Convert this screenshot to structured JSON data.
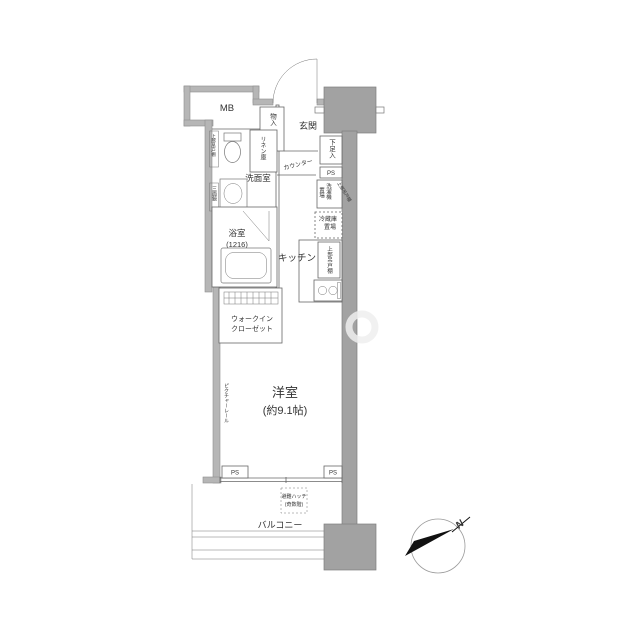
{
  "fp": {
    "mb": "MB",
    "entrance": "玄関",
    "storage": "物入",
    "shoe": "下足入",
    "ps": "PS",
    "washer_c1": "洗濯機",
    "washer_c2": "置場",
    "cab_tilt": "上部吊戸棚",
    "fridge1": "冷蔵庫",
    "fridge2": "置場",
    "cab_kitchen": "上部吊戸棚",
    "cab_washroom": "上部吊戸棚",
    "linen": "リネン庫",
    "washroom": "洗面室",
    "mirror": "三面鏡",
    "bath": "浴室",
    "bath_size": "(1216)",
    "counter": "カウンター",
    "kitchen": "キッチン",
    "wic1": "ウォークイン",
    "wic2": "クローゼット",
    "rail": "ピクチャーレール",
    "room": "洋室",
    "room_size": "(約9.1帖)",
    "hatch1": "避難ハッチ",
    "hatch2": "(奇数階)",
    "balcony": "バルコニー",
    "north": "N",
    "colors": {
      "wall": "#b6b6b6",
      "pillar": "#a2a2a2",
      "line": "#666666"
    }
  }
}
